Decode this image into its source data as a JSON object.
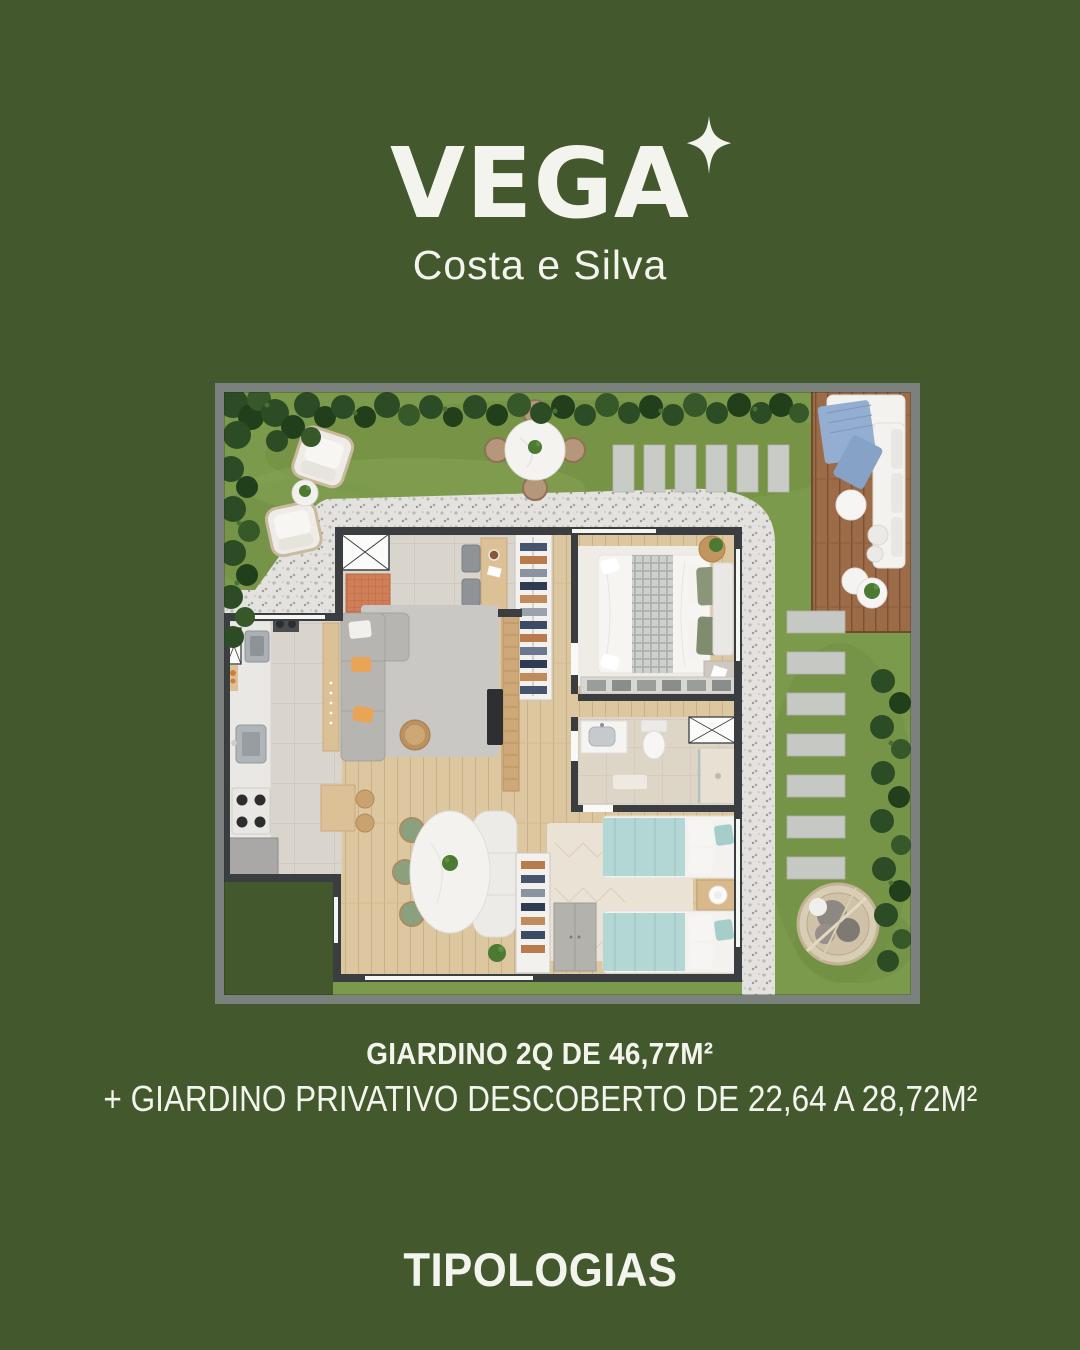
{
  "page": {
    "width": 1080,
    "height": 1350,
    "background_color": "#44582d",
    "text_color": "#f3f4ee"
  },
  "logo": {
    "brand": "VEGA",
    "subtitle": "Costa e Silva",
    "sparkle_icon": "four-point-star"
  },
  "caption": {
    "title": "GIARDINO 2Q DE 46,77M²",
    "subtitle": "+ GIARDINO PRIVATIVO DESCOBERTO DE 22,64 A 28,72M²"
  },
  "footer": {
    "title": "TIPOLOGIAS"
  },
  "floor_plan": {
    "type": "apartment-floor-plan-render",
    "view": "top-down",
    "palette": {
      "grass": "#7c9a4c",
      "hedge": "#2c4c25",
      "gravel": "#e3e2de",
      "deck_wood": "#9c6c49",
      "interior_wood": "#ddc7a0",
      "tile": "#d9d4cc",
      "walls": "#3b3e41",
      "frame": "#7b817d",
      "accent_pillow": "#e9a455",
      "kids_bedding": "#b2d7d5",
      "master_pillows": "#8a9579",
      "throw_blanket": "#93aed0",
      "terracotta_mat": "#cf7e57"
    },
    "garden_features": [
      "hedges",
      "lawn",
      "gravel-path",
      "lounge-armchairs",
      "plant-side-table",
      "round-dining-table-with-four-chairs",
      "concrete-paver-steps",
      "wood-deck-with-sectional-sofa",
      "blue-throw-blanket",
      "coffee-tables",
      "potted-plant",
      "stepping-stones",
      "hanging-egg-chair"
    ],
    "interior_features": [
      "entry-with-shaft-and-doormat",
      "desk-with-stools",
      "shoe-closet",
      "kitchen-with-sink-cooktop-and-counter",
      "living-sofa-with-orange-pillows",
      "tv-panel",
      "oval-dining-table-with-green-chairs",
      "master-bedroom-double-bed",
      "wardrobe",
      "bathroom-sink-toilet-shower",
      "kids-bedroom-two-single-beds",
      "nightstand-with-lamp"
    ]
  }
}
